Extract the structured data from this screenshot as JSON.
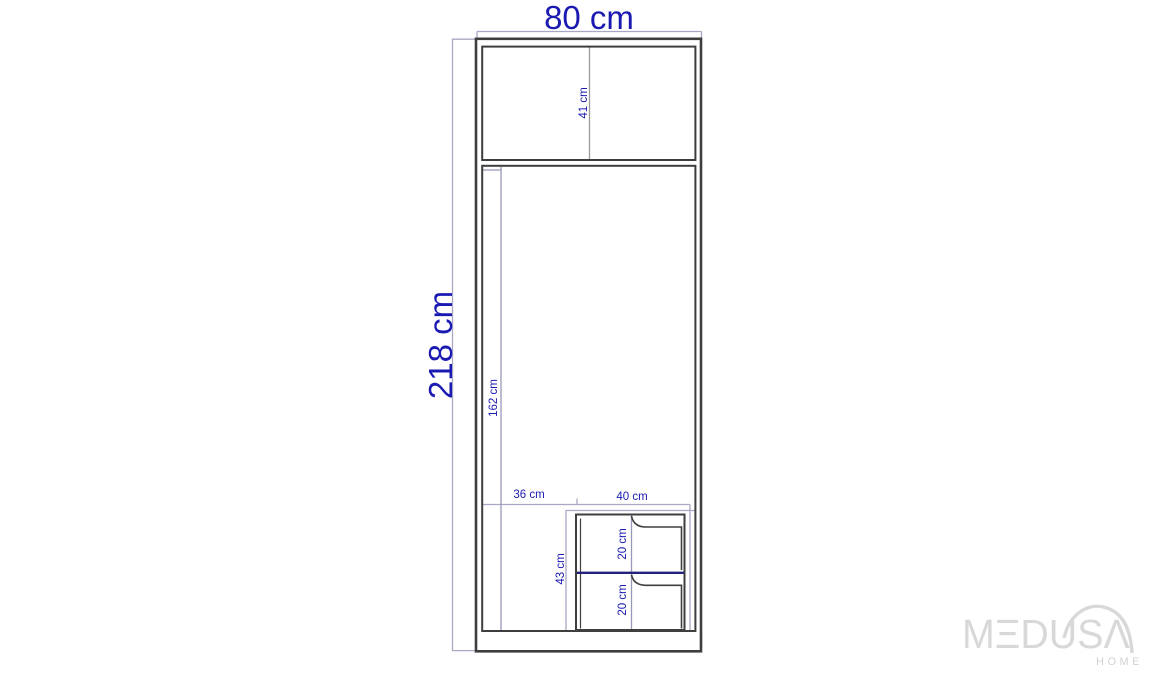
{
  "drawing": {
    "product": "wardrobe-dimension-diagram",
    "unit": "cm",
    "labels": {
      "overall_width": "80 cm",
      "overall_height": "218 cm",
      "top_shelf_height": "41 cm",
      "hanging_section_height": "162 cm",
      "left_section_width": "36 cm",
      "drawer_unit_width": "40 cm",
      "drawer_unit_height": "43 cm",
      "drawer_top_height": "20 cm",
      "drawer_bottom_height": "20 cm"
    },
    "colors": {
      "dimension_text": "#1a1ab2",
      "structure_line": "#3e3e3e",
      "dimension_line": "#a8a8c4",
      "divider_line": "#9a9a9a",
      "drawer_accent_line": "#22227c",
      "logo_gray": "#d8d8d8",
      "background": "#ffffff"
    }
  },
  "logo": {
    "brand": "MEDUSA",
    "wordmark": "MΞDUSΛ",
    "subtitle": "HOME"
  }
}
